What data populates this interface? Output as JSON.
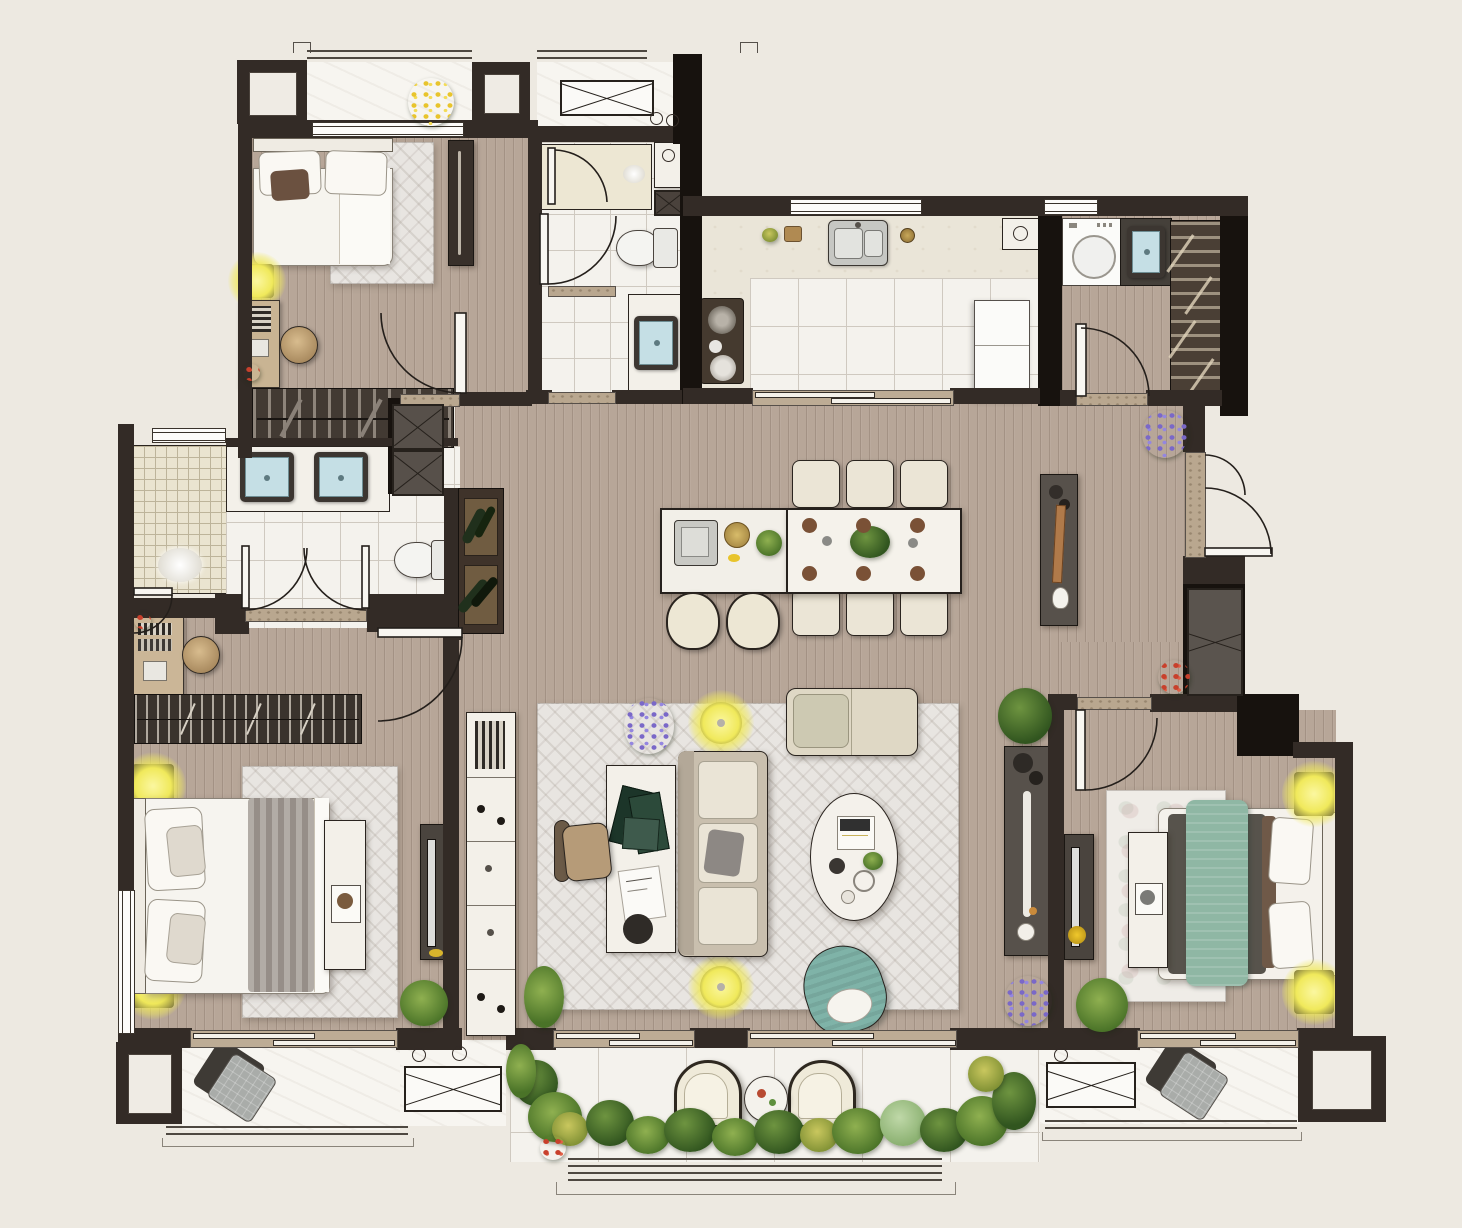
{
  "meta": {
    "document_type": "apartment-floor-plan-rendering",
    "view": "top-down",
    "visible_text": [],
    "units_shown": "none",
    "description": "Photorealistic rendered floor plan of a three-bedroom apartment with living-dining great room, kitchen, laundry, two and a half baths, entry hall and three balconies"
  },
  "palette": {
    "background": "#EDE9E1",
    "wall": "#332B26",
    "wall_black": "#17120E",
    "wood_floor": "#B7A698",
    "tile_floor": "#F4F2ED",
    "marble_counter": "#EAE5D8",
    "rug": "#E8E5E1",
    "furniture_white": "#F3F0E9",
    "furniture_dark": "#57514B",
    "accent_teal_chair": "#7FB3A8",
    "accent_green_bed": "#8FB7A4",
    "lamp_yellow": "#F0E95B",
    "sink_blue": "#C5DFE5",
    "plant_green": "#4A7328",
    "threshold_stone": "#B9A78F",
    "wood_desk": "#CBB697",
    "blanket_gray": "#9A948E",
    "pillow_brown": "#6B5140"
  },
  "rooms": [
    {
      "id": "balcony-top",
      "furniture": [
        "railing",
        "pillar",
        "potted-plant-yellow",
        "ac-unit"
      ]
    },
    {
      "id": "bedroom-1",
      "furniture": [
        "double-bed",
        "rug",
        "floor-lamp",
        "desk",
        "stool",
        "tall-cabinet",
        "wardrobe-closet",
        "door"
      ]
    },
    {
      "id": "bathroom-1",
      "furniture": [
        "shower",
        "toilet",
        "vanity-sink",
        "storage-niche",
        "doors"
      ]
    },
    {
      "id": "kitchen",
      "furniture": [
        "l-shaped-counter",
        "double-sink",
        "cooktop",
        "fridge",
        "sliding-door",
        "window"
      ]
    },
    {
      "id": "laundry",
      "furniture": [
        "washing-machine",
        "utility-sink",
        "slatted-shelf",
        "door"
      ]
    },
    {
      "id": "entry",
      "furniture": [
        "entry-door",
        "shoe-cabinet",
        "potted-plants"
      ]
    },
    {
      "id": "dining-area",
      "furniture": [
        "island-with-sink",
        "bar-stools",
        "dining-table-for-six",
        "dining-chairs",
        "decor-console"
      ]
    },
    {
      "id": "living-room",
      "furniture": [
        "area-rug",
        "sofa",
        "chaise-lounge",
        "oval-coffee-table",
        "desk-with-books",
        "office-chair",
        "teal-accent-chair",
        "floor-lamps",
        "media-console",
        "potted-plants"
      ]
    },
    {
      "id": "hallway",
      "furniture": [
        "bookcase-cabinet"
      ]
    },
    {
      "id": "master-bathroom",
      "furniture": [
        "double-vanity",
        "toilet",
        "double-doors",
        "shower-room",
        "wine-rack",
        "storage-boxes",
        "walkthrough-wardrobe"
      ]
    },
    {
      "id": "master-bedroom",
      "furniture": [
        "king-bed",
        "rug",
        "bookshelf",
        "vanity-desk",
        "stool",
        "bench",
        "tv-console",
        "floor-lamps",
        "potted-plant",
        "window"
      ]
    },
    {
      "id": "bedroom-2",
      "furniture": [
        "double-bed-green",
        "rug",
        "bench",
        "tv-console",
        "floor-lamps",
        "potted-plant",
        "door"
      ]
    },
    {
      "id": "balcony-left",
      "furniture": [
        "pillow-decor",
        "railing",
        "ac-unit"
      ]
    },
    {
      "id": "balcony-main",
      "furniture": [
        "armchair",
        "armchair",
        "round-table",
        "garden-plants",
        "railing"
      ]
    },
    {
      "id": "balcony-right",
      "furniture": [
        "pillow-decor",
        "railing",
        "ac-unit",
        "pillar"
      ]
    }
  ],
  "icons": [
    "door-arc",
    "window-lines",
    "x-cabinet-symbol",
    "plant-cluster",
    "lamp-glow",
    "sink-icon",
    "toilet-icon",
    "shower-icon",
    "washer-icon",
    "cooktop-icon"
  ]
}
